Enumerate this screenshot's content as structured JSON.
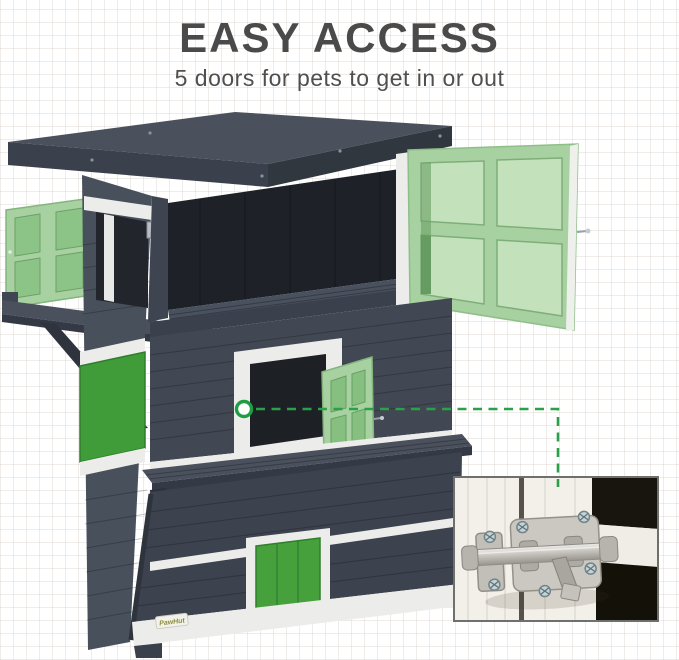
{
  "header": {
    "title": "EASY ACCESS",
    "subtitle": "5 doors for pets to get in or out"
  },
  "product": {
    "brand_label": "PawHut"
  },
  "icons": {
    "focus_marker": "circle-ring",
    "connector": "dashed-line"
  },
  "colors": {
    "accent_green": "#2ba04a",
    "door_light_green": "#a7d1a1",
    "panel_green": "#3f9c39",
    "bottom_door_green": "#46a13c",
    "house_dark": "#3c434e",
    "house_side": "#48505b",
    "interior_dark": "#1e2127",
    "trim_white": "#ecedeb",
    "title_gray": "#4a4a4a",
    "callout_background": "#f3f0e9",
    "latch_metal": "#c9c6c0"
  }
}
